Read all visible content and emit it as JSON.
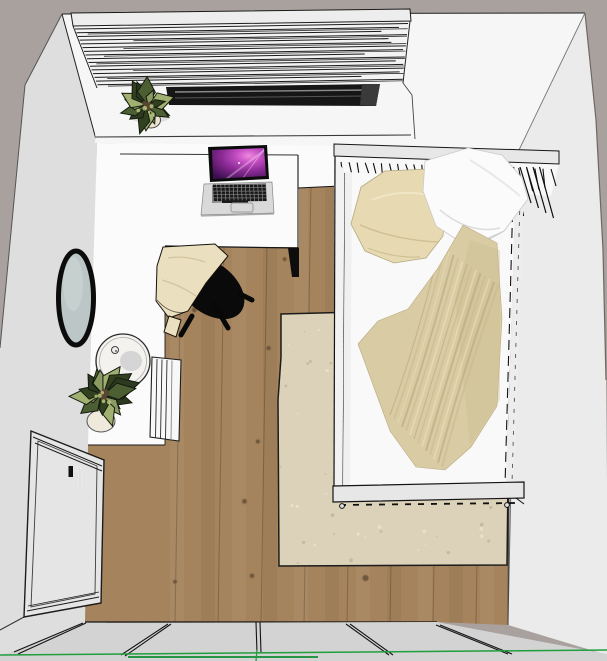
{
  "scene": {
    "label": "Top-down 3D viewport of a small bedroom (room-planner render)",
    "objects": [
      {
        "id": "window-blinds",
        "label": "Window with horizontal venetian blinds"
      },
      {
        "id": "window-opening",
        "label": "Dark window opening below blinds"
      },
      {
        "id": "windowsill-plant",
        "label": "Potted plant on windowsill"
      },
      {
        "id": "desk",
        "label": "White desk surface"
      },
      {
        "id": "laptop",
        "label": "Open laptop with purple galaxy wallpaper"
      },
      {
        "id": "desk-chair",
        "label": "Black chair with beige throw blanket"
      },
      {
        "id": "wall-mirror",
        "label": "Round wall mirror"
      },
      {
        "id": "side-table",
        "label": "Round white side table with vase"
      },
      {
        "id": "floor-plant",
        "label": "Potted floor plant"
      },
      {
        "id": "radiator",
        "label": "White slatted radiator"
      },
      {
        "id": "door",
        "label": "Room door with handle"
      },
      {
        "id": "bed",
        "label": "Single bed with slatted headboard, two pillows and crumpled blanket"
      },
      {
        "id": "rug",
        "label": "Beige speckled area rug"
      },
      {
        "id": "wood-floor",
        "label": "Wooden plank floor"
      },
      {
        "id": "green-axis",
        "label": "Green modeling axis line"
      }
    ],
    "colors": {
      "outside": "#a9a19d",
      "wall_top": "#f6f6f6",
      "wall_left": "#dedede",
      "wall_right": "#ebebeb",
      "floor_white": "#fbfbfb",
      "band": "#d3d3d3",
      "wood": "#a5845d",
      "wood_dark": "#6d5338",
      "rug": "#dcd2b9",
      "rug_speck_dark": "#c2b494",
      "rug_speck_light": "#ece4d0",
      "bed_frame": "#e7e7e7",
      "sheet": "#f9f9f9",
      "pillow_beige": "#e7dab2",
      "pillow_white": "#fbfbfb",
      "blanket": "#d9cba3",
      "blanket_fold": "#b9aa80",
      "throw": "#eadfbe",
      "chair_black": "#0a0a0a",
      "mirror_glass": "#bcc6c6",
      "door": "#e5e5e5",
      "laptop_body": "#d9d9d9",
      "table_white": "#f4f2ee",
      "pot_cream": "#ece4d1",
      "leaf_dark": "#2c3a20",
      "leaf_mid": "#4c5f33",
      "leaf_light": "#8a9a63",
      "green_axis": "#1f9e3d",
      "line": "#161616"
    }
  }
}
